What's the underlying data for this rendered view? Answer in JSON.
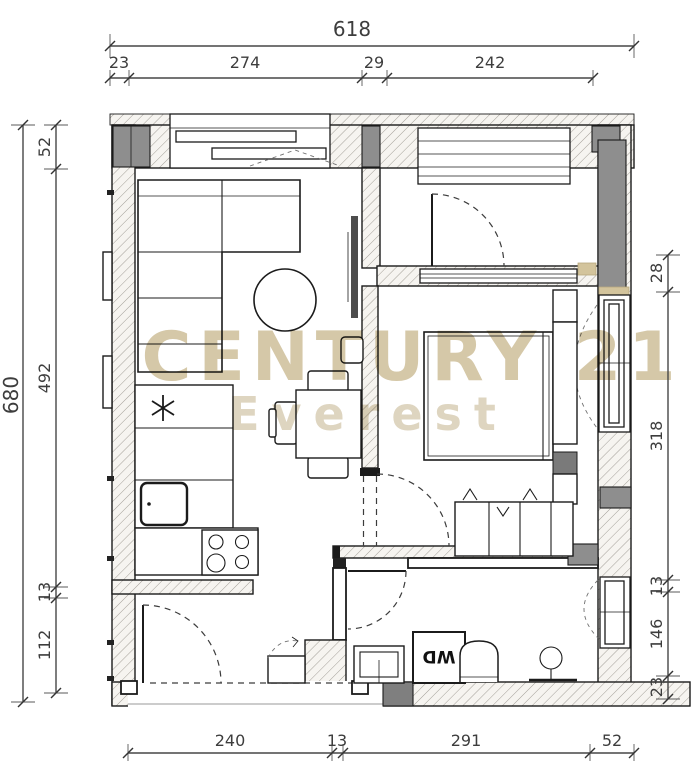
{
  "watermark": {
    "brand": "CENTURY 21",
    "subbrand": "Everest"
  },
  "labels": {
    "washer_dryer": "WD"
  },
  "dimensions": {
    "top": {
      "overall": "618",
      "segments": [
        "23",
        "274",
        "29",
        "242"
      ]
    },
    "left": {
      "overall": "680",
      "segments": [
        "52",
        "492",
        "13",
        "112"
      ]
    },
    "right": {
      "segments": [
        "28",
        "318",
        "13",
        "146",
        "23"
      ]
    },
    "bottom": {
      "segments": [
        "240",
        "13",
        "291",
        "52"
      ]
    }
  },
  "colors": {
    "watermark_primary": "#d5c8a8",
    "watermark_secondary": "#ded5c0",
    "wall_gray": "#8e8e8e",
    "accent_tan": "#d3c49c",
    "line": "#1b1b1b"
  }
}
